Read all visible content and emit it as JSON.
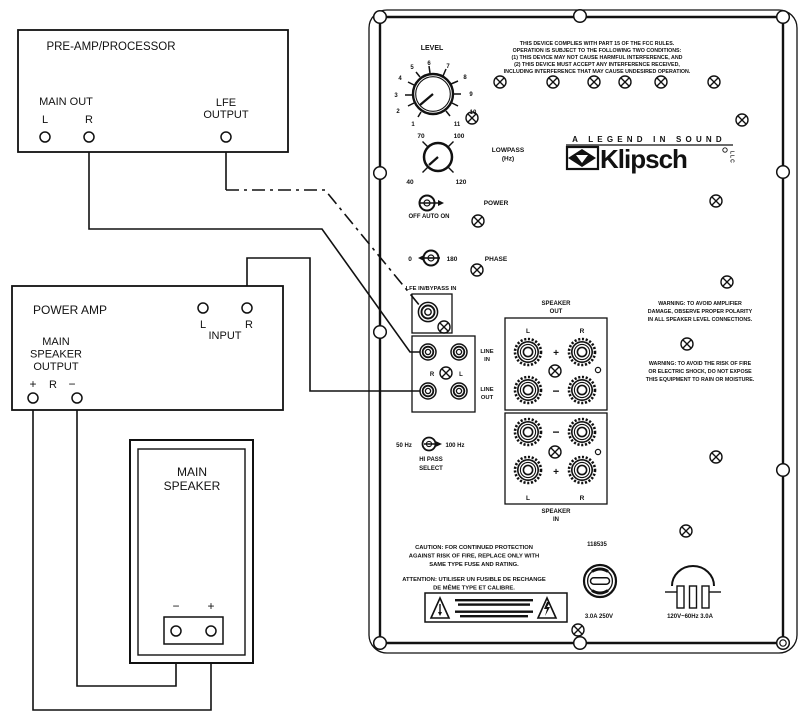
{
  "boxes": {
    "preamp": {
      "title": "PRE-AMP/PROCESSOR",
      "main_out_label": "MAIN OUT",
      "left_label": "L",
      "right_label": "R",
      "lfe_label_lines": [
        "LFE",
        "OUTPUT"
      ]
    },
    "poweramp": {
      "title": "POWER AMP",
      "left_label": "L",
      "right_label": "R",
      "input_label": "INPUT",
      "output_label_lines": [
        "MAIN",
        "SPEAKER",
        "OUTPUT"
      ],
      "plus_label": "+",
      "r_label": "R",
      "minus_label": "−"
    },
    "speaker": {
      "title_lines": [
        "MAIN",
        "SPEAKER"
      ],
      "minus_label": "−",
      "plus_label": "+"
    }
  },
  "panel": {
    "fcc_lines": [
      "THIS DEVICE COMPLIES WITH PART 15 OF THE FCC RULES.",
      "OPERATION IS SUBJECT TO THE FOLLOWING TWO CONDITIONS:",
      "(1) THIS DEVICE MAY NOT CAUSE HARMFUL INTERFERENCE, AND",
      "(2) THIS DEVICE MUST ACCEPT ANY INTERFERENCE RECEIVED,",
      "INCLUDING INTERFERENCE THAT MAY CAUSE UNDESIRED OPERATION."
    ],
    "level": {
      "label": "LEVEL",
      "ticks": [
        "1",
        "2",
        "3",
        "4",
        "5",
        "6",
        "7",
        "8",
        "9",
        "10",
        "11"
      ]
    },
    "lowpass": {
      "label_lines": [
        "LOWPASS",
        "(Hz)"
      ],
      "tick_40": "40",
      "tick_70": "70",
      "tick_100": "100",
      "tick_120": "120"
    },
    "power": {
      "label": "POWER",
      "modes_label": "OFF AUTO ON"
    },
    "phase": {
      "label": "PHASE",
      "deg0": "0",
      "deg180": "180"
    },
    "brand": {
      "tagline": "A LEGEND IN SOUND",
      "name": "Klipsch",
      "suffix": "LLC"
    },
    "lfe_in_label": "LFE IN/BYPASS IN",
    "line_io": {
      "r_label": "R",
      "l_label": "L",
      "in_lines": [
        "LINE",
        "IN"
      ],
      "out_lines": [
        "LINE",
        "OUT"
      ]
    },
    "speaker_out": {
      "label_lines": [
        "SPEAKER",
        "OUT"
      ],
      "l": "L",
      "r": "R",
      "plus": "+",
      "minus": "−"
    },
    "speaker_in": {
      "label_lines": [
        "SPEAKER",
        "IN"
      ],
      "l": "L",
      "r": "R",
      "plus": "+",
      "minus": "−"
    },
    "warning_polarity_lines": [
      "WARNING: TO AVOID AMPLIFIER",
      "DAMAGE, OBSERVE PROPER POLARITY",
      "IN ALL SPEAKER LEVEL CONNECTIONS."
    ],
    "warning_moisture_lines": [
      "WARNING: TO AVOID THE RISK OF FIRE",
      "OR ELECTRIC SHOCK, DO NOT EXPOSE",
      "THIS EQUIPMENT TO RAIN OR MOISTURE."
    ],
    "hipass": {
      "f50": "50 Hz",
      "f100": "100 Hz",
      "label_lines": [
        "HI PASS",
        "SELECT"
      ]
    },
    "caution_lines": [
      "CAUTION: FOR CONTINUED PROTECTION",
      "AGAINST RISK OF FIRE, REPLACE ONLY WITH",
      "SAME TYPE FUSE AND RATING."
    ],
    "attention_lines": [
      "ATTENTION: UTILISER UN FUSIBLE DE RECHANGE",
      "DE MÊME TYPE ET CALIBRE."
    ],
    "fuse": {
      "part_number": "118535",
      "rating": "3.0A 250V"
    },
    "mains": {
      "rating": "120V~60Hz 3.0A"
    }
  }
}
